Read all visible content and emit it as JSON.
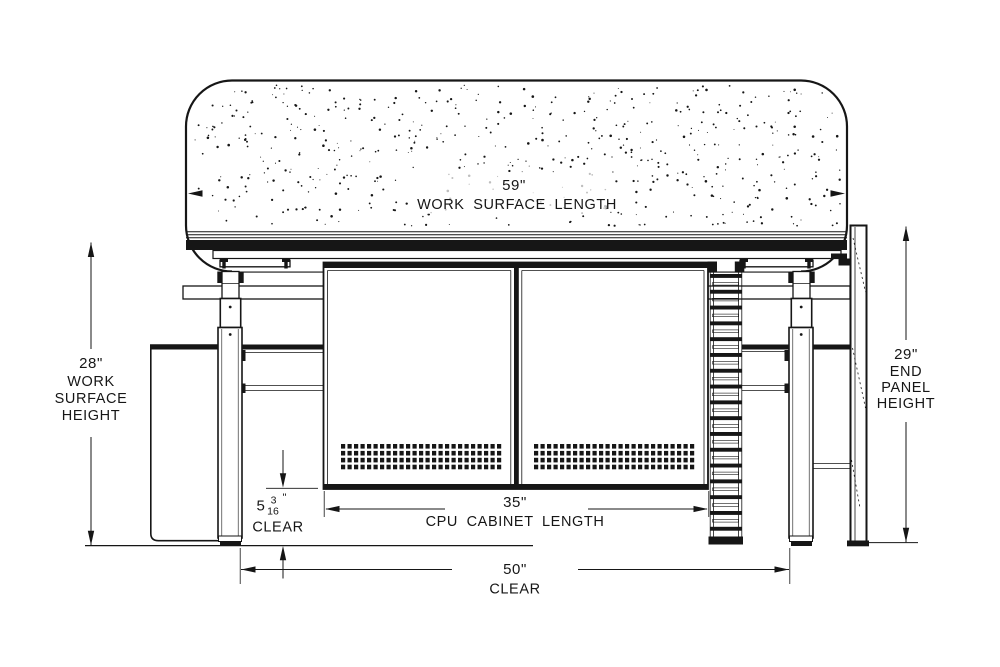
{
  "style": {
    "line_color": "#161616",
    "bg_color": "#ffffff"
  },
  "dimensions": {
    "work_surface_length": {
      "value": "59\"",
      "label": "WORK SURFACE LENGTH"
    },
    "work_surface_height": {
      "value": "28\"",
      "label_lines": [
        "WORK",
        "SURFACE",
        "HEIGHT"
      ]
    },
    "end_panel_height": {
      "value": "29\"",
      "label_lines": [
        "END",
        "PANEL",
        "HEIGHT"
      ]
    },
    "cpu_cabinet_length": {
      "value": "35\"",
      "label": "CPU CABINET LENGTH"
    },
    "bottom_clearance": {
      "whole": "5",
      "numerator": "3",
      "denominator": "16",
      "unit": "\"",
      "label": "CLEAR"
    },
    "width_clearance": {
      "value": "50\"",
      "label": "CLEAR"
    }
  }
}
